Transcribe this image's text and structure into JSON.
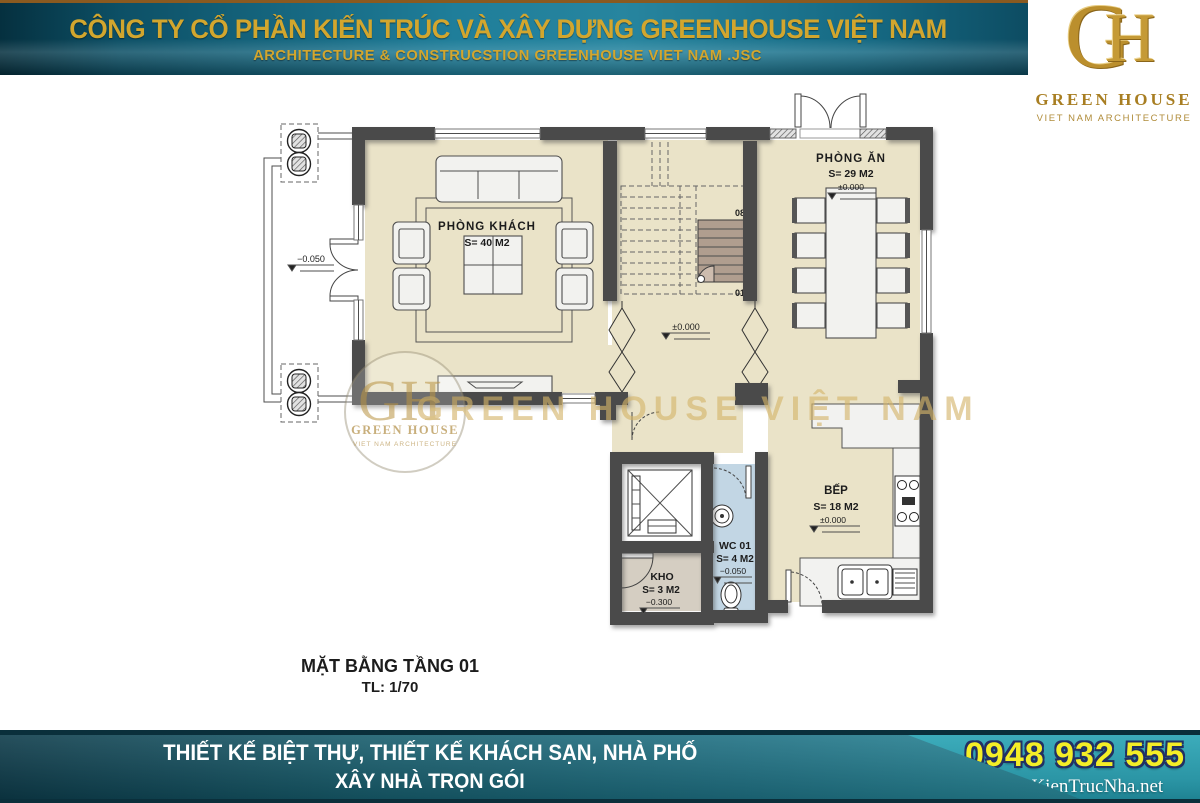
{
  "header": {
    "line1": "CÔNG TY CỔ PHẦN KIẾN TRÚC VÀ XÂY DỰNG GREENHOUSE VIỆT NAM",
    "line2": "ARCHITECTURE & CONSTRUCSTION GREENHOUSE VIET NAM .JSC"
  },
  "logo": {
    "monogram_g": "G",
    "monogram_h": "H",
    "name": "GREEN HOUSE",
    "tagline": "VIET NAM ARCHITECTURE"
  },
  "plan": {
    "title": "MẶT BẰNG TẦNG 01",
    "scale": "TL: 1/70",
    "rooms": [
      {
        "name": "PHÒNG KHÁCH",
        "area": "S= 40 M2"
      },
      {
        "name": "PHÒNG ĂN",
        "area": "S= 29 M2",
        "level": "±0.000"
      },
      {
        "name": "BẾP",
        "area": "S= 18 M2",
        "level": "±0.000"
      },
      {
        "name": "WC 01",
        "area": "S= 4 M2",
        "level": "−0.050"
      },
      {
        "name": "KHO",
        "area": "S= 3 M2",
        "level": "−0.300"
      }
    ],
    "hall_level": "±0.000",
    "porch_level": "−0.050",
    "stair_top": "08",
    "stair_bottom": "01"
  },
  "watermark": {
    "monogram": "GH",
    "name": "GREEN HOUSE",
    "tagline": "VIET NAM ARCHITECTURE",
    "big_text": "GREEN HOUSE VIỆT NAM"
  },
  "footer": {
    "line1": "THIẾT KẾ BIỆT THỰ, THIẾT KẾ KHÁCH SẠN, NHÀ PHỐ",
    "line2": "XÂY NHÀ TRỌN GÓI",
    "phone": "0948 932 555",
    "website": "www.KienTrucNha.net"
  },
  "colors": {
    "banner_gold": "#d2a62e",
    "wall": "#4a4a4a",
    "floor": "#eae3c8",
    "wc_floor": "#c2d6e4",
    "kho_floor": "#d5cec2",
    "stair_fill": "#b09e8f",
    "watermark_gold": "#d3b469",
    "phone_yellow": "#f4ee27"
  }
}
